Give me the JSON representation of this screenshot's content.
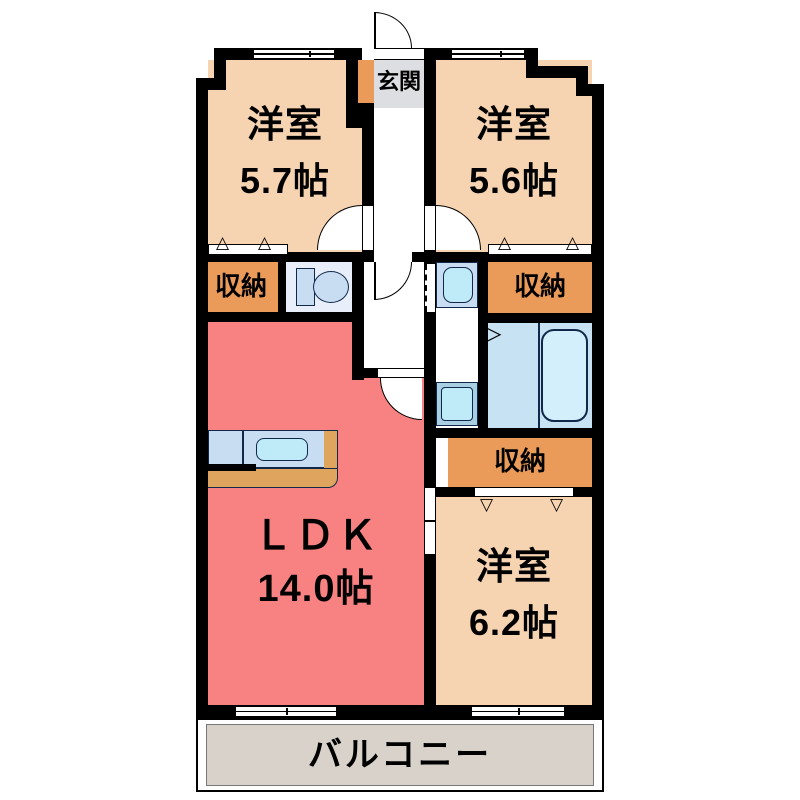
{
  "plan": {
    "entrance": {
      "label": "玄関"
    },
    "rooms": {
      "western1": {
        "name": "洋室",
        "size": "5.7帖"
      },
      "western2": {
        "name": "洋室",
        "size": "5.6帖"
      },
      "western3": {
        "name": "洋室",
        "size": "6.2帖"
      },
      "ldk": {
        "name": "ＬＤＫ",
        "size": "14.0帖"
      },
      "balcony": {
        "name": "バルコニー"
      }
    },
    "closets": [
      {
        "label": "収納"
      },
      {
        "label": "収納"
      },
      {
        "label": "収納"
      }
    ]
  },
  "icons": {
    "closet_door_up": "△",
    "closet_door_down": "▽",
    "bath_folding_door": "▷"
  },
  "colors": {
    "wall": "#000000",
    "room_fill": "#f6d3b1",
    "ldk_fill": "#f88181",
    "storage_fill": "#eb9b59",
    "genkan_fill": "#dcdee2",
    "balcony_fill": "#d8d2cb",
    "toilet_room_fill": "#e9effa",
    "fixture_blue": "#c9ddf2",
    "water_blue": "#bfeaf8",
    "bath_fill": "#c7e3f3",
    "tub_fill": "#d3effb",
    "counter_tan": "#dfa55f",
    "pan_blue": "#a9cfe3",
    "fixture_outline": "#11284b"
  }
}
